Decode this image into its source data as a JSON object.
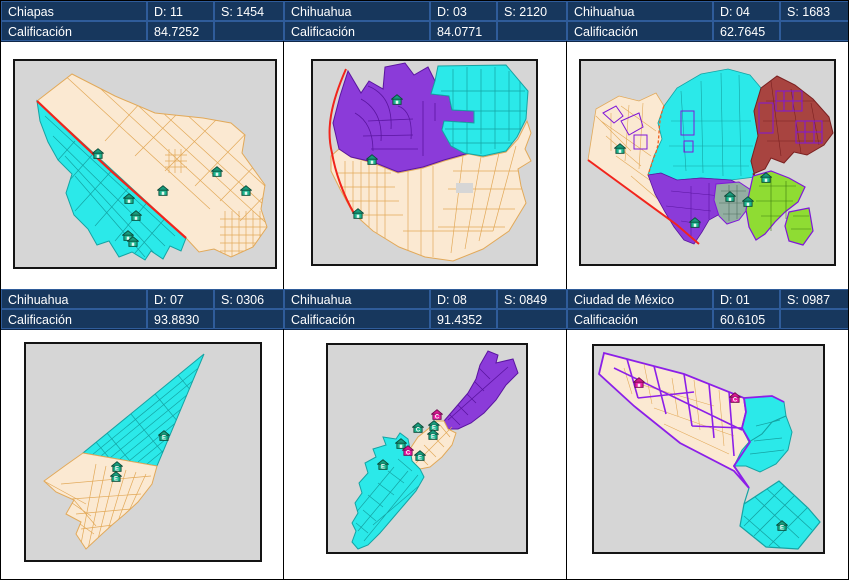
{
  "report": {
    "panels": [
      {
        "state": "Chiapas",
        "district": "D: 11",
        "section": "S: 1454",
        "score_label": "Calificación",
        "score": "84.7252",
        "markers": [
          {
            "x": 32,
            "y": 45,
            "c": "teal",
            "t": ""
          },
          {
            "x": 44,
            "y": 67,
            "c": "teal",
            "t": ""
          },
          {
            "x": 46.5,
            "y": 75,
            "c": "teal",
            "t": ""
          },
          {
            "x": 43.5,
            "y": 85,
            "c": "teal",
            "t": ""
          },
          {
            "x": 45.5,
            "y": 88,
            "c": "teal",
            "t": ""
          },
          {
            "x": 57,
            "y": 63,
            "c": "teal",
            "t": ""
          },
          {
            "x": 77.5,
            "y": 54,
            "c": "teal",
            "t": ""
          },
          {
            "x": 89,
            "y": 63,
            "c": "teal",
            "t": ""
          }
        ]
      },
      {
        "state": "Chihuahua",
        "district": "D: 03",
        "section": "S: 2120",
        "score_label": "Calificación",
        "score": "84.0771",
        "markers": [
          {
            "x": 37.5,
            "y": 19,
            "c": "teal",
            "t": ""
          },
          {
            "x": 26.5,
            "y": 49,
            "c": "teal",
            "t": ""
          },
          {
            "x": 20,
            "y": 75.5,
            "c": "teal",
            "t": ""
          }
        ]
      },
      {
        "state": "Chihuahua",
        "district": "D: 04",
        "section": "S: 1683",
        "score_label": "Calificación",
        "score": "62.7645",
        "markers": [
          {
            "x": 15.5,
            "y": 43.5,
            "c": "teal",
            "t": ""
          },
          {
            "x": 73,
            "y": 57.5,
            "c": "teal",
            "t": ""
          },
          {
            "x": 59,
            "y": 67,
            "c": "teal",
            "t": ""
          },
          {
            "x": 66,
            "y": 69.5,
            "c": "teal",
            "t": ""
          },
          {
            "x": 45,
            "y": 80,
            "c": "teal",
            "t": ""
          }
        ]
      },
      {
        "state": "Chihuahua",
        "district": "D: 07",
        "section": "S: 0306",
        "score_label": "Calificación",
        "score": "93.8830",
        "markers": [
          {
            "x": 59,
            "y": 42.5,
            "c": "teal",
            "t": "E"
          },
          {
            "x": 39,
            "y": 57,
            "c": "teal",
            "t": "E"
          },
          {
            "x": 38.5,
            "y": 61.5,
            "c": "teal",
            "t": "E"
          }
        ]
      },
      {
        "state": "Chihuahua",
        "district": "D: 08",
        "section": "S: 0849",
        "score_label": "Calificación",
        "score": "91.4352",
        "markers": [
          {
            "x": 55,
            "y": 34,
            "c": "magenta",
            "t": "C"
          },
          {
            "x": 45.5,
            "y": 40,
            "c": "teal",
            "t": "C"
          },
          {
            "x": 53.5,
            "y": 39,
            "c": "teal",
            "t": "E"
          },
          {
            "x": 53,
            "y": 43.5,
            "c": "teal",
            "t": "E"
          },
          {
            "x": 37,
            "y": 48,
            "c": "teal",
            "t": ""
          },
          {
            "x": 40.5,
            "y": 51,
            "c": "magenta",
            "t": "C"
          },
          {
            "x": 46.5,
            "y": 53.5,
            "c": "teal",
            "t": "E"
          },
          {
            "x": 28,
            "y": 58,
            "c": "teal",
            "t": "E"
          }
        ]
      },
      {
        "state": "Ciudad de México",
        "district": "D: 01",
        "section": "S: 0987",
        "score_label": "Calificación",
        "score": "60.6105",
        "markers": [
          {
            "x": 19.5,
            "y": 18,
            "c": "magenta",
            "t": ""
          },
          {
            "x": 61.5,
            "y": 25,
            "c": "magenta",
            "t": "C"
          },
          {
            "x": 82,
            "y": 87.5,
            "c": "teal",
            "t": "E"
          }
        ]
      }
    ],
    "colors": {
      "header_bg": "#17375D",
      "header_border": "#2F5C9A",
      "header_text": "#FFFFFF",
      "map_bg": "#D6D6D6",
      "cream_fill": "#FBE9D2",
      "cream_line": "#E2A959",
      "cyan_fill": "#2BE9E9",
      "cyan_line": "#15A3A3",
      "purple_fill": "#8B3BD9",
      "purple_line": "#5A15A0",
      "brick_fill": "#A84440",
      "brick_line": "#7A2020",
      "green_fill": "#8FDC33",
      "slate_fill": "#93AEA2",
      "violet_outline": "#7F16D9",
      "red_boundary": "#F1241C",
      "marker_teal": "#1CB48F",
      "marker_magenta": "#EC1FA6"
    }
  }
}
